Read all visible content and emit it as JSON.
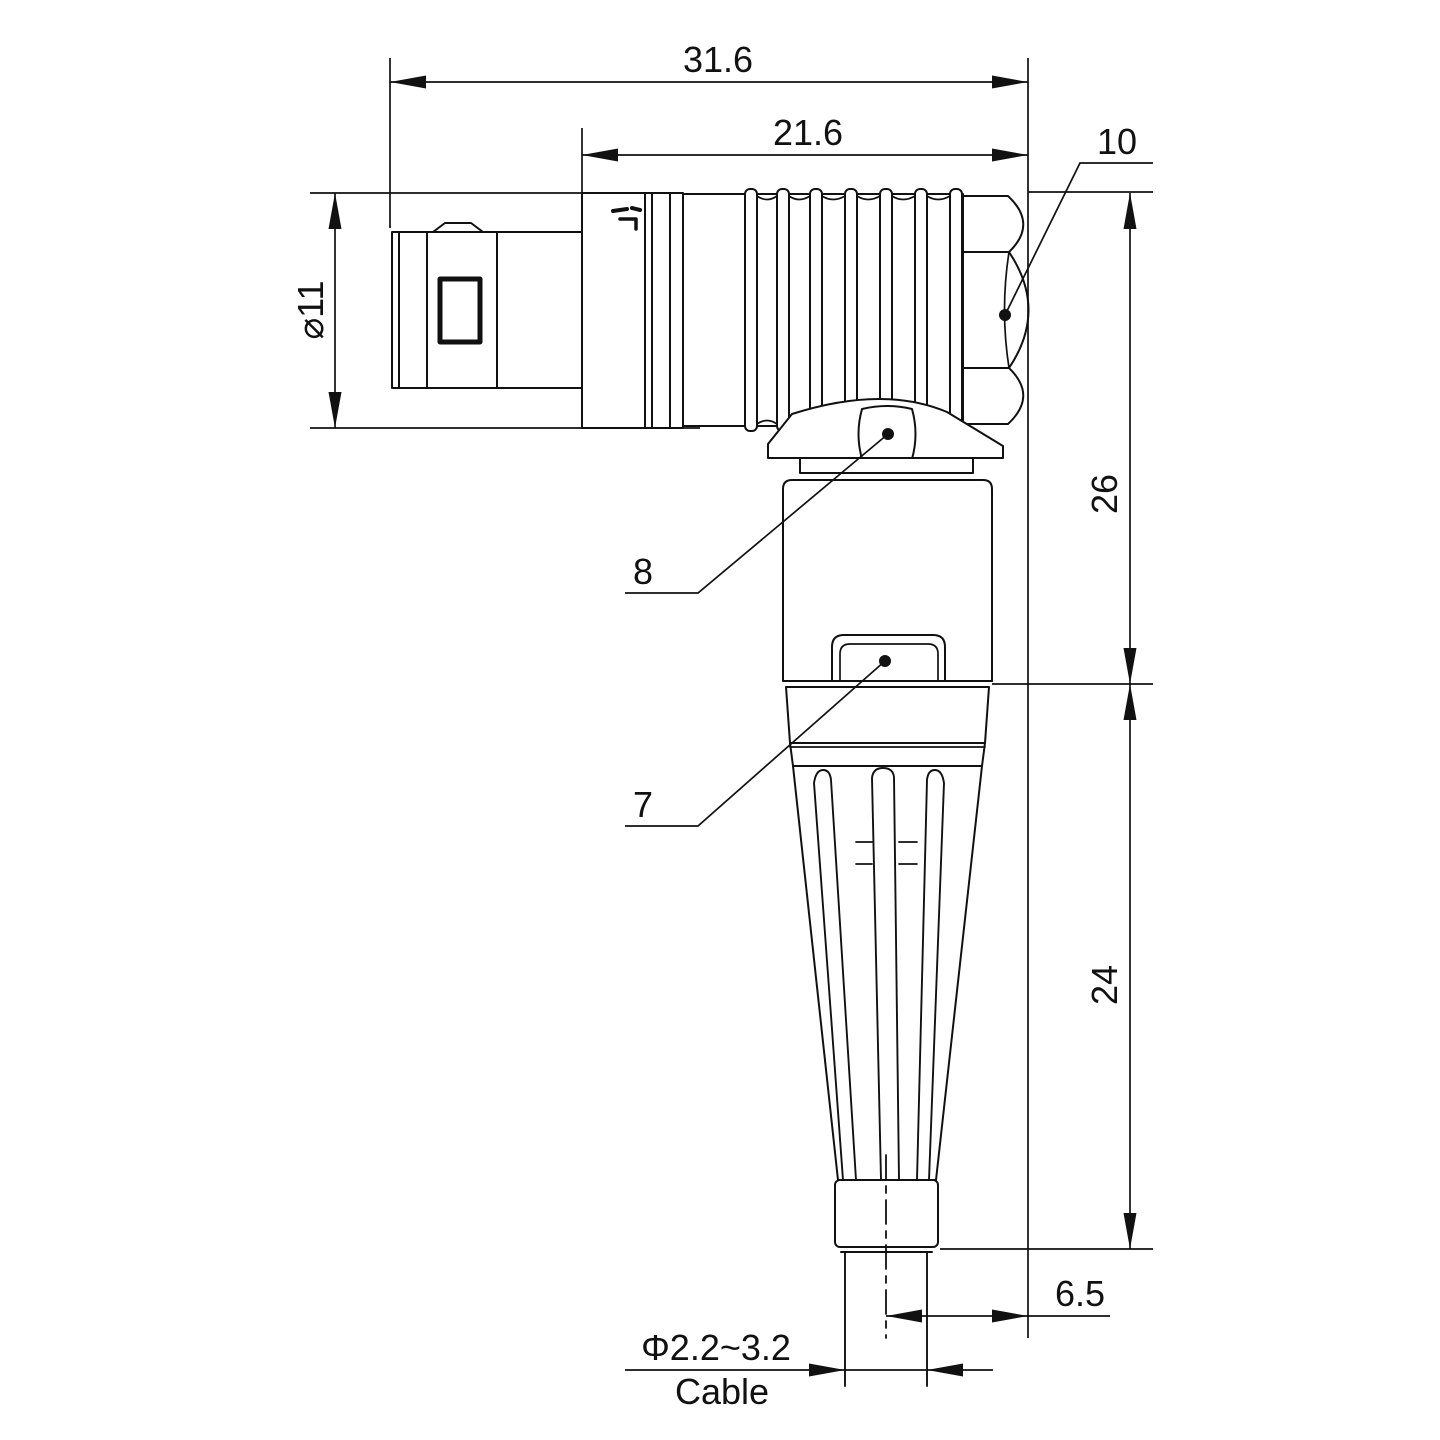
{
  "watermark": {
    "text": "Lightany",
    "color": "#efb9b7"
  },
  "colors": {
    "line": "#111111",
    "background": "#ffffff"
  },
  "dimensions": {
    "overall_length": "31.6",
    "rear_length": "21.6",
    "nut_across_flats": "10",
    "body_diameter": "⌀11",
    "height_upper": "26",
    "height_lower": "24",
    "cable_offset": "6.5",
    "cable_diameter": "Φ2.2~3.2",
    "cable_label": "Cable",
    "callout_elbow_nut": "8",
    "callout_boot_clip": "7"
  }
}
